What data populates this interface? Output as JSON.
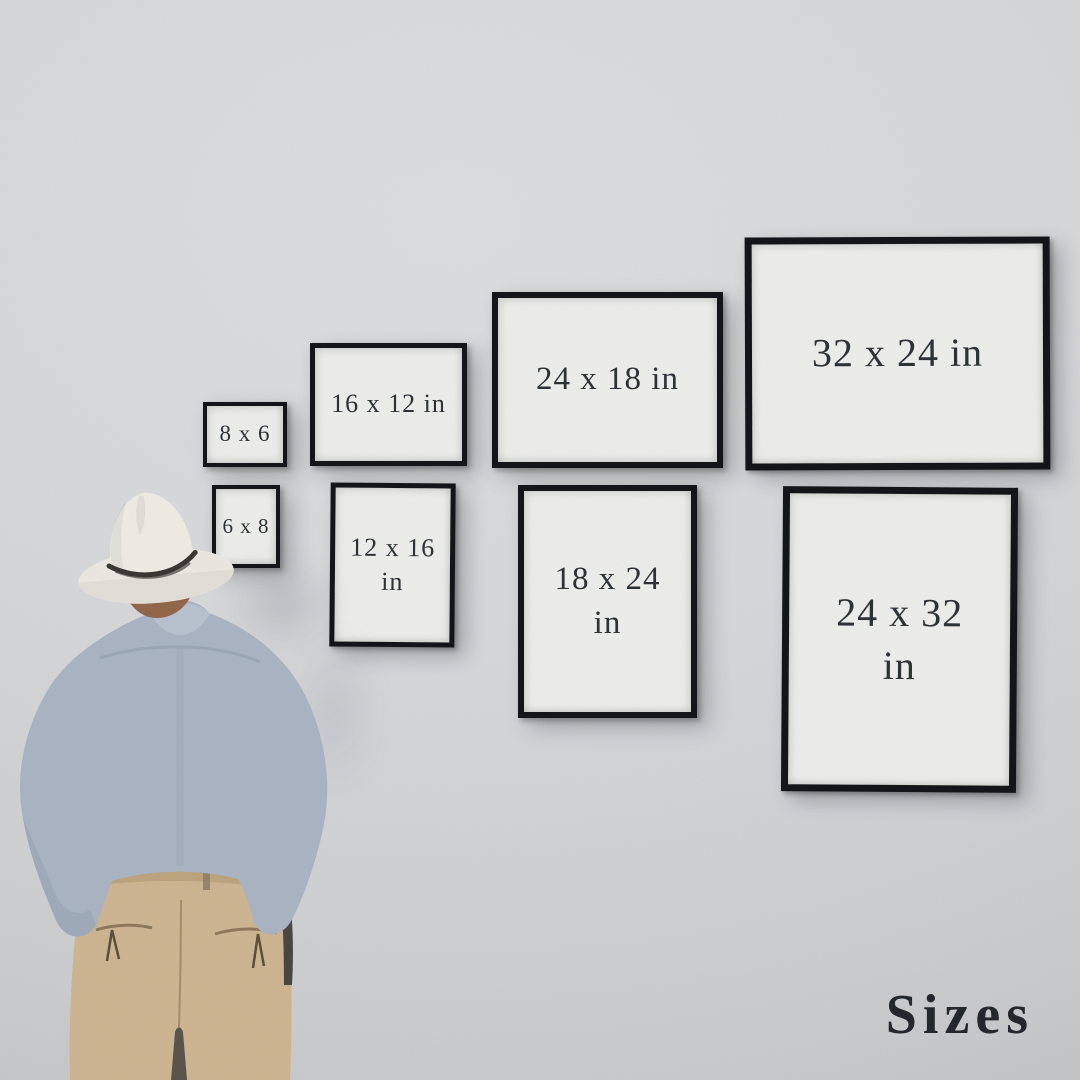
{
  "title": {
    "text": "Sizes"
  },
  "frames": [
    {
      "label": "8 x 6",
      "lines": [
        "8 x 6"
      ],
      "width_in": 8,
      "height_in": 6,
      "orientation": "landscape"
    },
    {
      "label": "16 x 12 in",
      "lines": [
        "16 x 12 in"
      ],
      "width_in": 16,
      "height_in": 12,
      "orientation": "landscape"
    },
    {
      "label": "24 x 18 in",
      "lines": [
        "24 x 18 in"
      ],
      "width_in": 24,
      "height_in": 18,
      "orientation": "landscape"
    },
    {
      "label": "32 x 24 in",
      "lines": [
        "32 x 24 in"
      ],
      "width_in": 32,
      "height_in": 24,
      "orientation": "landscape"
    },
    {
      "label": "6 x 8",
      "lines": [
        "6 x 8"
      ],
      "width_in": 6,
      "height_in": 8,
      "orientation": "portrait"
    },
    {
      "label": "12 x 16 in",
      "lines": [
        "12 x 16",
        "in"
      ],
      "width_in": 12,
      "height_in": 16,
      "orientation": "portrait"
    },
    {
      "label": "18 x 24 in",
      "lines": [
        "18 x 24",
        "in"
      ],
      "width_in": 18,
      "height_in": 24,
      "orientation": "portrait"
    },
    {
      "label": "24 x 32 in",
      "lines": [
        "24 x 32",
        "in"
      ],
      "width_in": 24,
      "height_in": 32,
      "orientation": "portrait"
    }
  ],
  "colors": {
    "wall": "#d5d6d8",
    "frame_border": "#141518",
    "frame_face": "#ecedeb",
    "label_text": "#2d3237",
    "title_text": "#24282d",
    "hat": "#edebe4",
    "hat_band": "#3b3733",
    "hair": "#92664a",
    "shirt": "#a9b4c2",
    "shirt_collar": "#b8c2cf",
    "trousers": "#cdb592",
    "strap": "#4a4641"
  }
}
